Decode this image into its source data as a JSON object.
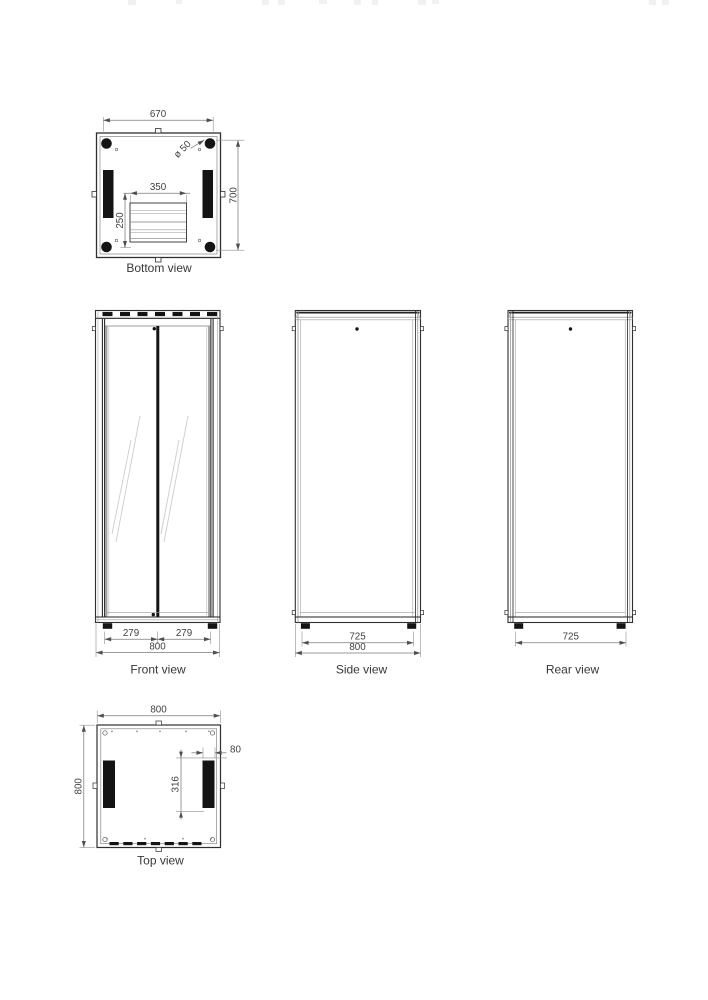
{
  "colors": {
    "outline": "#2f2f2f",
    "detail_line": "#8a8a8a",
    "dimension_line": "#7a7a7a",
    "arrow": "#4f4f4f",
    "dark_fill": "#141414",
    "text": "#3f3f3f",
    "background": "#ffffff"
  },
  "views": {
    "bottom": {
      "label": "Bottom view",
      "width": "670",
      "depth": "700",
      "cutout_width": "350",
      "cutout_depth": "250",
      "caster_diameter": "ø 50"
    },
    "front": {
      "label": "Front view",
      "door_left_width": "279",
      "door_right_width": "279",
      "overall_width": "800"
    },
    "side": {
      "label": "Side view",
      "foot_spacing": "725",
      "overall_depth": "800"
    },
    "rear": {
      "label": "Rear view",
      "foot_spacing": "725"
    },
    "top": {
      "label": "Top view",
      "overall_width": "800",
      "overall_depth": "800",
      "slot_width": "80",
      "slot_length": "316"
    }
  }
}
